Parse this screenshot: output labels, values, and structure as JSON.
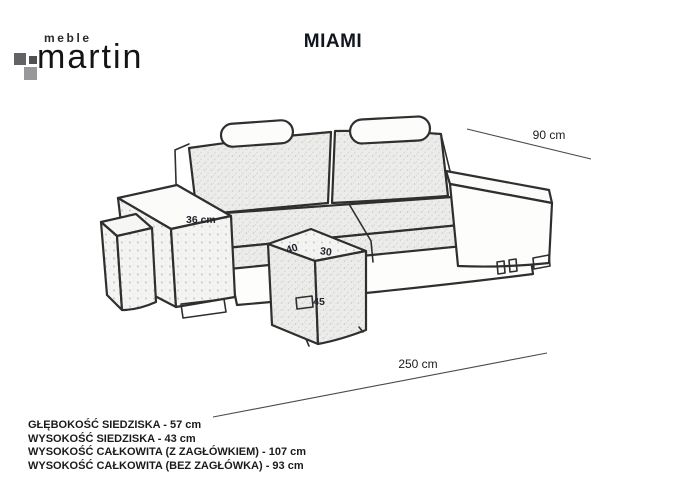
{
  "brand": {
    "line1": "meble",
    "line2": "martin"
  },
  "title": "MIAMI",
  "drawing": {
    "subject": "three-seat sofa with headrests, armrest pouf and front pouf, hand-sketch style"
  },
  "dimensions": {
    "depth_label": "90 cm",
    "length_label": "250 cm",
    "armrest_label": "36 cm",
    "pouf_depth": "40",
    "pouf_width": "30",
    "pouf_height": "45"
  },
  "specs": [
    "GŁĘBOKOŚĆ SIEDZISKA - 57 cm",
    "WYSOKOŚĆ SIEDZISKA - 43 cm",
    "WYSOKOŚĆ CAŁKOWITA (Z ZAGŁÓWKIEM) - 107 cm",
    "WYSOKOŚĆ CAŁKOWITA (BEZ ZAGŁÓWKA) - 93 cm"
  ],
  "colors": {
    "outline": "#2f2f2f",
    "dimension_line": "#4a4a4a",
    "upholstery_fill": "#ececea",
    "upholstery_light_fill": "#f4f4f2",
    "logo_square_dark": "#636366",
    "logo_square_darker": "#515154",
    "logo_square_light": "#96989a",
    "text": "#1b1b1b"
  }
}
